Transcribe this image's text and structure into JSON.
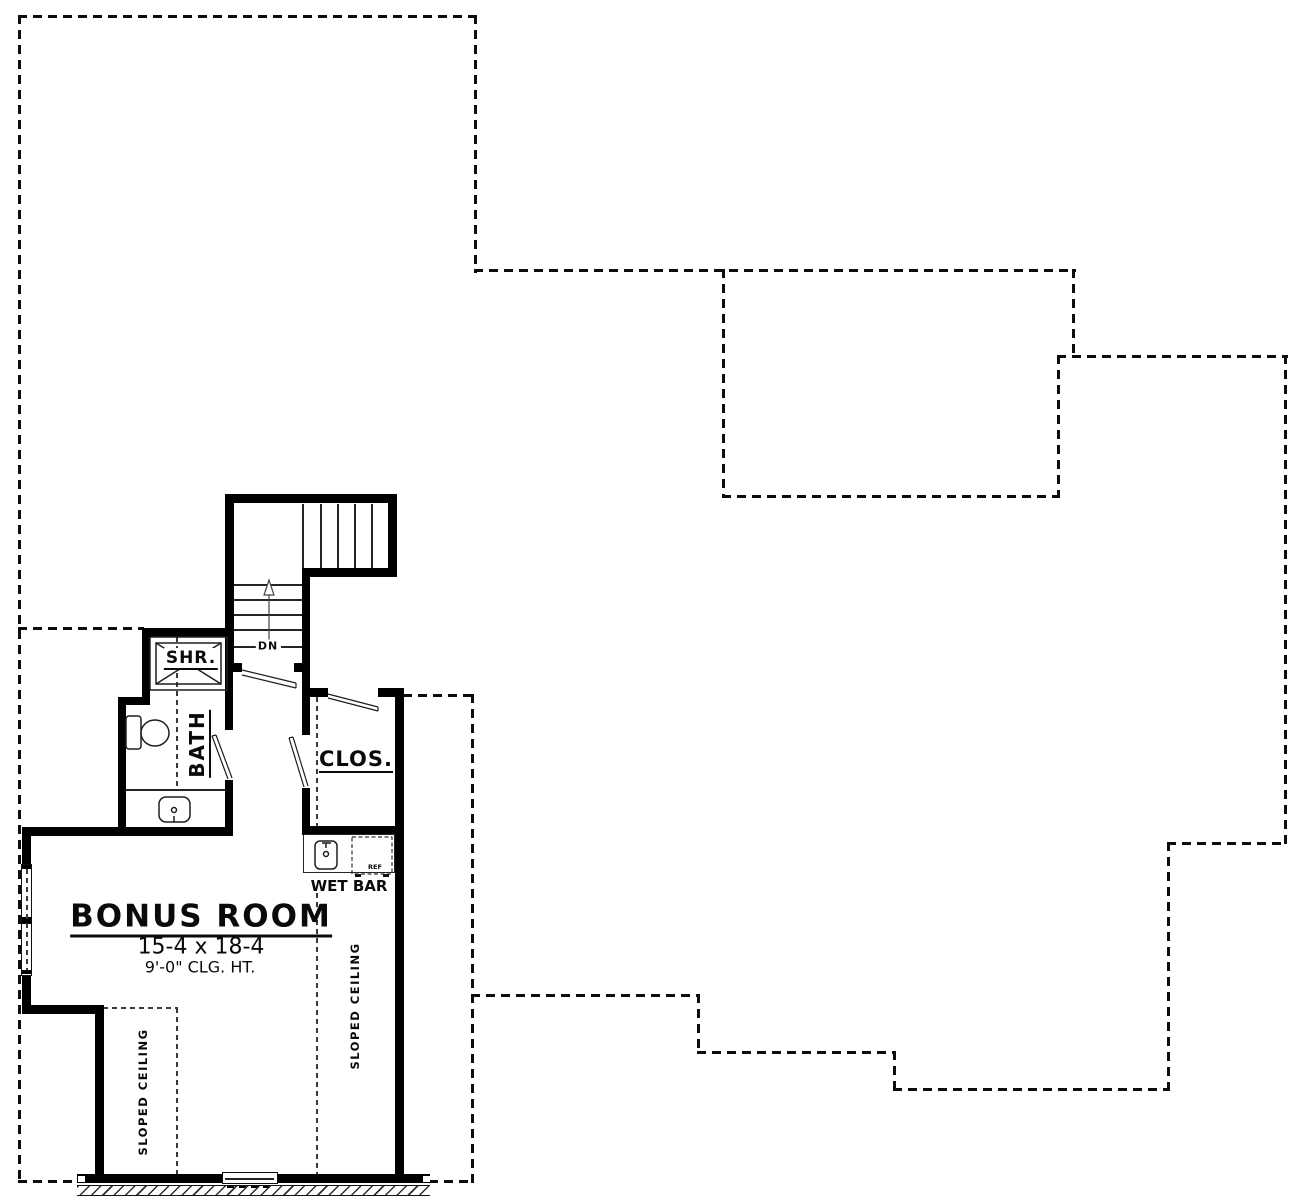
{
  "plan": {
    "rooms": {
      "bonus": {
        "name": "BONUS ROOM",
        "dims": "15-4 x 18-4",
        "clg": "9'-0\" CLG. HT."
      },
      "bath": {
        "name": "BATH"
      },
      "shower": {
        "name": "SHR."
      },
      "closet": {
        "name": "CLOS."
      },
      "wet_bar": {
        "name": "WET BAR"
      }
    },
    "stairs": {
      "dn_label": "DN"
    },
    "annotations": {
      "sloped_ceiling": "SLOPED CEILING",
      "ref": "REF"
    },
    "colors": {
      "wall": "#000000",
      "line": "#252525",
      "dash": "#0d0d0d",
      "background": "#ffffff"
    }
  }
}
